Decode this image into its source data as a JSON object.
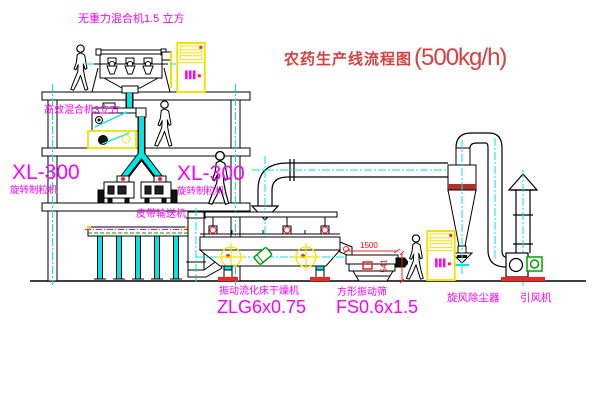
{
  "title": {
    "text": "农药生产线流程图",
    "capacity": "(500kg/h)"
  },
  "labels": {
    "gravity_mixer": "无重力混合机1.5 立方",
    "high_eff_mixer": "高效混合机3立方",
    "granulator_left_model": "XL-300",
    "granulator_left_name": "旋转制粒机",
    "granulator_right_model": "XL-300",
    "granulator_right_name": "旋转制粒机",
    "belt_conveyor": "皮带输送机",
    "dryer_name": "振动流化床干燥机",
    "dryer_model": "ZLG6x0.75",
    "screen_name": "方形振动筛",
    "screen_model": "FS0.6x1.5",
    "cyclone": "旋风除尘器",
    "fan": "引风机"
  },
  "dimensions": {
    "screen_length": "1500",
    "screen_height": "541"
  },
  "colors": {
    "linework": "#000000",
    "centerline": "#00e6e6",
    "label_magenta": "#ff00ff",
    "title_red": "#d94040",
    "cabinet_yellow": "#efe400",
    "accent_red": "#ff0000",
    "motor_green": "#00a000",
    "background": "#ffffff"
  }
}
